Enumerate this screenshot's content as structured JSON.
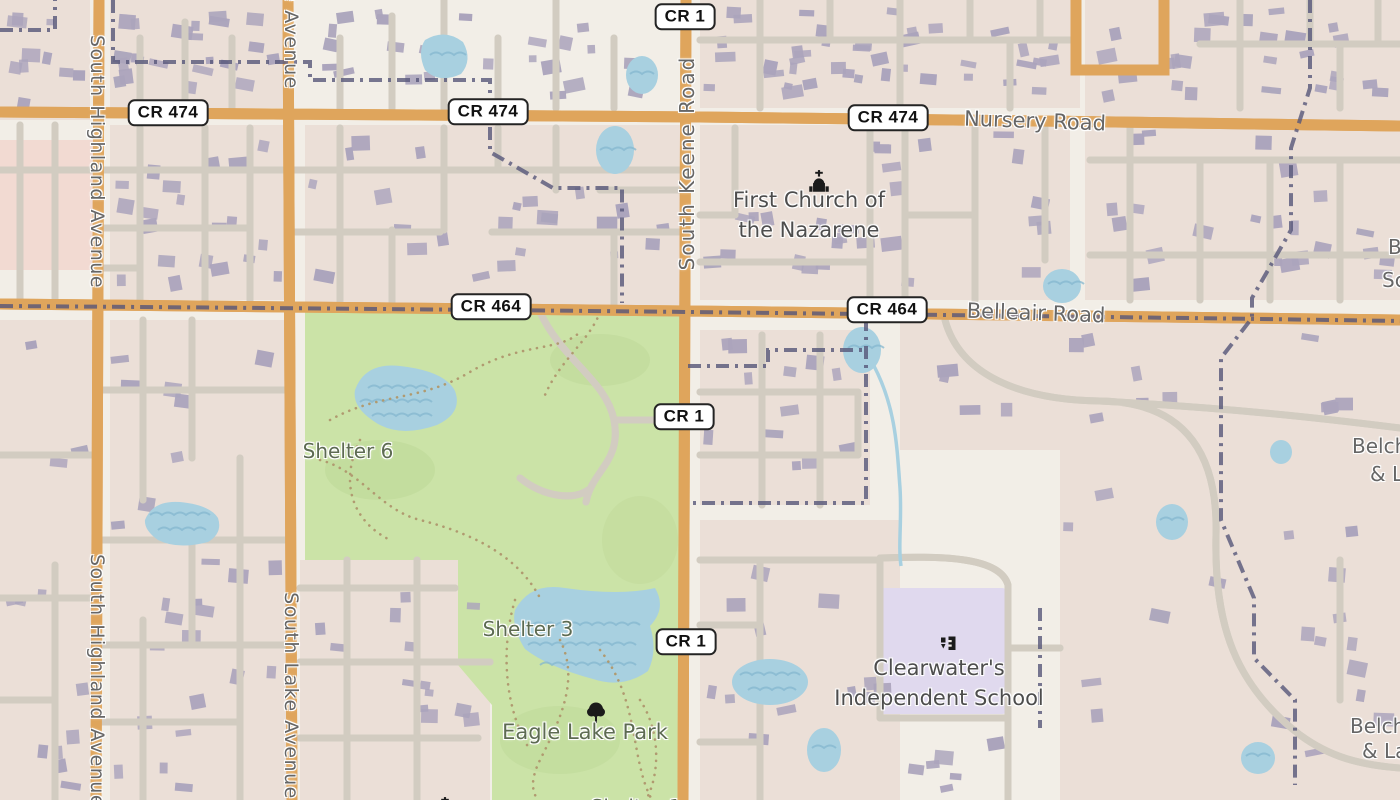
{
  "map": {
    "shields": [
      {
        "label": "CR 1",
        "x": 685,
        "y": 17
      },
      {
        "label": "CR 474",
        "x": 168,
        "y": 113
      },
      {
        "label": "CR 474",
        "x": 488,
        "y": 112
      },
      {
        "label": "CR 474",
        "x": 888,
        "y": 118
      },
      {
        "label": "CR 464",
        "x": 491,
        "y": 307
      },
      {
        "label": "CR 464",
        "x": 887,
        "y": 310
      },
      {
        "label": "CR 1",
        "x": 684,
        "y": 417
      },
      {
        "label": "CR 1",
        "x": 686,
        "y": 642
      }
    ],
    "street_labels": [
      {
        "text": "Nursery Road",
        "x": 1035,
        "y": 121,
        "rotate": 2,
        "size": 21
      },
      {
        "text": "Belleair Road",
        "x": 1036,
        "y": 313,
        "rotate": 2,
        "size": 21
      },
      {
        "text": "South Keene Road",
        "x": 687,
        "y": 163,
        "rotate": -90,
        "size": 20,
        "ls": 2
      },
      {
        "text": "South Highland Avenue",
        "x": 97,
        "y": 162,
        "rotate": 90,
        "size": 19,
        "ls": 1.5
      },
      {
        "text": "South Highland Avenue",
        "x": 97,
        "y": 681,
        "rotate": 90,
        "size": 19,
        "ls": 1.5
      },
      {
        "text": "South Lake Avenue",
        "x": 291,
        "y": -14,
        "rotate": 90,
        "size": 19,
        "ls": 1.5
      },
      {
        "text": "South Lake Avenue",
        "x": 291,
        "y": 696,
        "rotate": 90,
        "size": 19,
        "ls": 1.5
      }
    ],
    "poi_labels": [
      {
        "lines": [
          "First Church of",
          "the Nazarene"
        ],
        "x": 809,
        "y": 186,
        "size": 21,
        "icon": "church",
        "icon_x": 806,
        "icon_y": 169,
        "color_key": "poi_label"
      },
      {
        "lines": [
          "Clearwater's",
          "Independent School"
        ],
        "x": 939,
        "y": 654,
        "size": 21,
        "icon": "school",
        "icon_x": 936,
        "icon_y": 633,
        "color_key": "poi_label"
      },
      {
        "lines": [
          "Eagle Lake Park"
        ],
        "x": 585,
        "y": 718,
        "size": 21,
        "icon": "tree",
        "icon_x": 584,
        "icon_y": 701,
        "color_key": "park_label"
      },
      {
        "lines": [
          "Shelter 6"
        ],
        "x": 348,
        "y": 437,
        "size": 20,
        "color_key": "park_label"
      },
      {
        "lines": [
          "Shelter 3"
        ],
        "x": 528,
        "y": 615,
        "size": 20,
        "color_key": "park_label"
      },
      {
        "lines": [],
        "icon": "church",
        "icon_x": 432,
        "icon_y": 796
      }
    ],
    "partial_edge_labels": [
      {
        "text": "B",
        "x": 1388,
        "y": 247,
        "anchor": "left",
        "size": 20
      },
      {
        "text": "Sc",
        "x": 1382,
        "y": 280,
        "anchor": "left",
        "size": 20
      },
      {
        "text": "Belch",
        "x": 1352,
        "y": 446,
        "anchor": "left",
        "size": 20
      },
      {
        "text": "& L",
        "x": 1370,
        "y": 474,
        "anchor": "left",
        "size": 20
      },
      {
        "text": "Belch",
        "x": 1350,
        "y": 726,
        "anchor": "left",
        "size": 20
      },
      {
        "text": "& La",
        "x": 1362,
        "y": 751,
        "anchor": "left",
        "size": 20
      },
      {
        "text": "Shelter 1",
        "x": 636,
        "y": 807,
        "anchor": "center",
        "size": 20,
        "color_key": "park_label"
      }
    ],
    "icons": [
      "church-icon",
      "school-icon",
      "tree-icon"
    ],
    "colors": {
      "land": "#f2eee7",
      "residential": "#ebdfd7",
      "retail_pink": "#f2dad2",
      "park": "#cbe3a7",
      "park_dark": "#bdd897",
      "water": "#a8d0e0",
      "wave": "#84b7cf",
      "school_area": "#e0d9ee",
      "road_yellow_fill": "#f9da85",
      "road_yellow_casing": "#dfa55c",
      "road_white_casing": "#d2ccc1",
      "boundary": "#565679",
      "building": "#aba4bc",
      "trail": "#b09a70",
      "street_label": "#666666",
      "poi_label": "#4d4d4d",
      "park_label": "#5d6b52"
    }
  }
}
